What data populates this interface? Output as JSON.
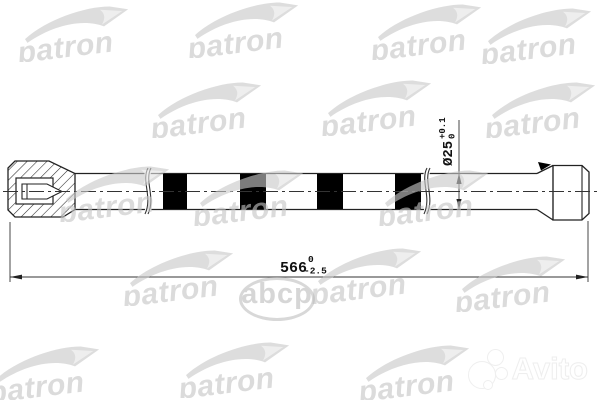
{
  "brand_watermark": {
    "label": "patron"
  },
  "abcp": {
    "label": "abcp"
  },
  "avito": {
    "label": "Avito"
  },
  "drawing": {
    "part_type": "torsion-bar-shaft",
    "line_color": "#222222",
    "band_color": "#000000",
    "dimensions": {
      "length": {
        "main": "566",
        "tol_upper": "0",
        "tol_lower": "-2.5"
      },
      "diameter": {
        "main": "Ø25",
        "tol_upper": "+0.1",
        "tol_lower": "0"
      }
    }
  }
}
